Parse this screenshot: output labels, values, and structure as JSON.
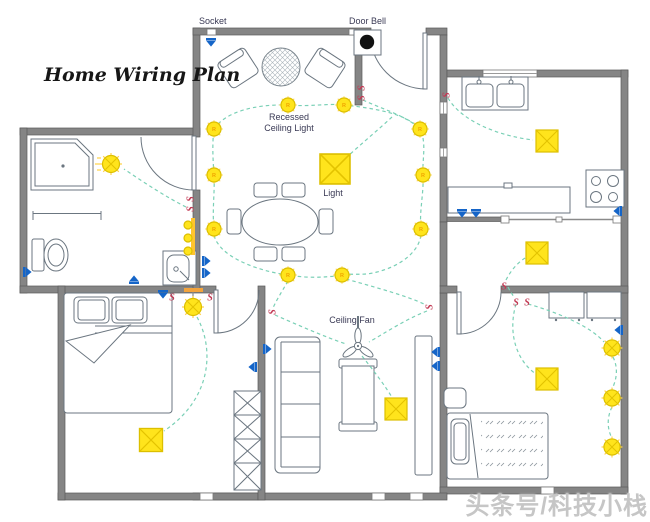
{
  "title": "Home Wiring Plan",
  "labels": {
    "socket": "Socket",
    "door_bell": "Door Bell",
    "recessed_line1": "Recessed",
    "recessed_line2": "Ceiling Light",
    "light": "Light",
    "ceiling_fan": "Ceiling Fan"
  },
  "symbols": {
    "switch": "S",
    "recessed_marker": "R",
    "socket_color": "#1565c8",
    "switch_color": "#c23b55",
    "light_fill": "#ffe41c",
    "light_stroke": "#dcbf00",
    "wire_color": "#7ad0b6",
    "wall_color": "#858585"
  },
  "watermark": "头条号/科技小栈"
}
